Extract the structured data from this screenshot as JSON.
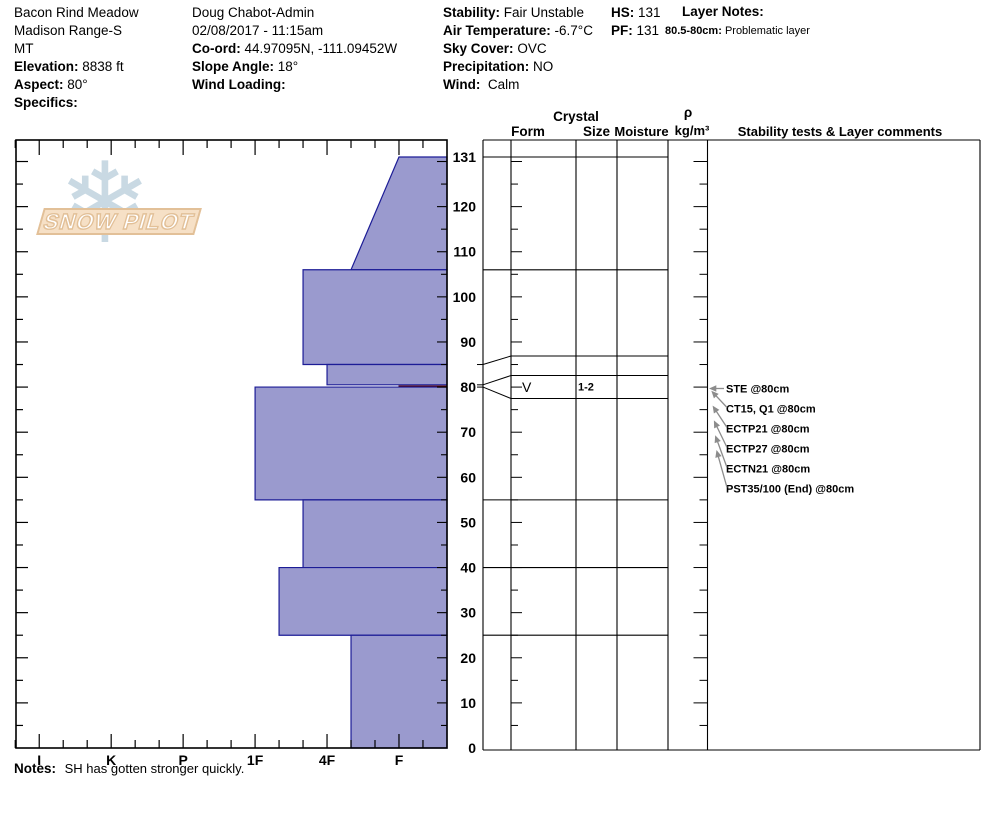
{
  "report": {
    "location": {
      "name": "Bacon Rind Meadow",
      "range": "Madison Range-S",
      "state": "MT",
      "elevation_label": "Elevation:",
      "elevation": "8838 ft",
      "aspect_label": "Aspect:",
      "aspect": "80°",
      "specifics_label": "Specifics:",
      "specifics": ""
    },
    "observer": {
      "name": "Doug Chabot-Admin",
      "datetime": "02/08/2017 - 11:15am",
      "coord_label": "Co-ord:",
      "coordinates": "44.97095N, -111.09452W",
      "slope_angle_label": "Slope Angle:",
      "slope_angle": "18°",
      "wind_loading_label": "Wind Loading:",
      "wind_loading": ""
    },
    "conditions": {
      "stability_label": "Stability:",
      "stability": "Fair Unstable",
      "air_temp_label": "Air Temperature:",
      "air_temp": "-6.7°C",
      "sky_cover_label": "Sky Cover:",
      "sky_cover": "OVC",
      "precipitation_label": "Precipitation:",
      "precipitation": "NO",
      "wind_label": "Wind:",
      "wind": "Calm"
    },
    "totals": {
      "hs_label": "HS:",
      "hs": "131",
      "pf_label": "PF:",
      "pf": "131"
    },
    "layer_notes": {
      "label": "Layer Notes:",
      "entry_range": "80.5-80cm:",
      "entry_text": "Problematic layer"
    },
    "notes": {
      "label": "Notes:",
      "text": "SH has gotten stronger quickly."
    }
  },
  "logo": {
    "text": "SNOW PILOT",
    "snowflake": "❄",
    "band_color": "#f6e0c6",
    "band_outline": "#e2c098",
    "snowflake_color": "#c9d9e3"
  },
  "table_headers": {
    "crystal": "Crystal",
    "form": "Form",
    "size": "Size",
    "moisture": "Moisture",
    "rho": "ρ",
    "rho_units": "kg/m³",
    "stability": "Stability tests & Layer comments"
  },
  "chart_data": {
    "type": "bar",
    "subtype": "snowpit-hardness-profile",
    "title": "SnowPilot hardness profile",
    "hardness_axis": {
      "labels": [
        "I",
        "K",
        "P",
        "1F",
        "4F",
        "F"
      ],
      "note": "hand hardness, hardest (I) left to softest (F) right; bars grow leftward from the right edge"
    },
    "depth_axis": {
      "unit": "cm",
      "min": 0,
      "max": 131,
      "tick_labels": [
        131,
        120,
        110,
        100,
        90,
        80,
        70,
        60,
        50,
        40,
        30,
        20,
        10,
        0
      ]
    },
    "layers": [
      {
        "top_cm": 131,
        "bottom_cm": 106,
        "hardness_top": "F",
        "hardness_bottom": "4F-"
      },
      {
        "top_cm": 106,
        "bottom_cm": 85,
        "hardness_top": "4F+",
        "hardness_bottom": "4F+"
      },
      {
        "top_cm": 85,
        "bottom_cm": 80.5,
        "hardness_top": "4F",
        "hardness_bottom": "4F"
      },
      {
        "top_cm": 80.5,
        "bottom_cm": 80,
        "hardness_top": "F",
        "hardness_bottom": "F",
        "weak_layer": true,
        "form_symbol": "V",
        "grain_form": "surface hoar",
        "grain_size_mm": "1-2"
      },
      {
        "top_cm": 80,
        "bottom_cm": 55,
        "hardness_top": "1F",
        "hardness_bottom": "1F"
      },
      {
        "top_cm": 55,
        "bottom_cm": 40,
        "hardness_top": "4F+",
        "hardness_bottom": "4F+"
      },
      {
        "top_cm": 40,
        "bottom_cm": 25,
        "hardness_top": "1F-",
        "hardness_bottom": "1F-"
      },
      {
        "top_cm": 25,
        "bottom_cm": 0,
        "hardness_top": "4F-",
        "hardness_bottom": "4F-"
      }
    ],
    "stability_tests": [
      {
        "label": "STE @80cm",
        "depth_cm": 80
      },
      {
        "label": "CT15, Q1 @80cm",
        "depth_cm": 80
      },
      {
        "label": "ECTP21 @80cm",
        "depth_cm": 80
      },
      {
        "label": "ECTP27 @80cm",
        "depth_cm": 80
      },
      {
        "label": "ECTN21 @80cm",
        "depth_cm": 80
      },
      {
        "label": "PST35/100 (End) @80cm",
        "depth_cm": 80
      }
    ],
    "colors": {
      "bar_fill": "#9a9ace",
      "bar_stroke": "#1c1c96",
      "weak_fill": "#b51616",
      "weak_stroke": "#5c0000",
      "grid": "#000000",
      "arrow": "#8c8c8c"
    }
  }
}
